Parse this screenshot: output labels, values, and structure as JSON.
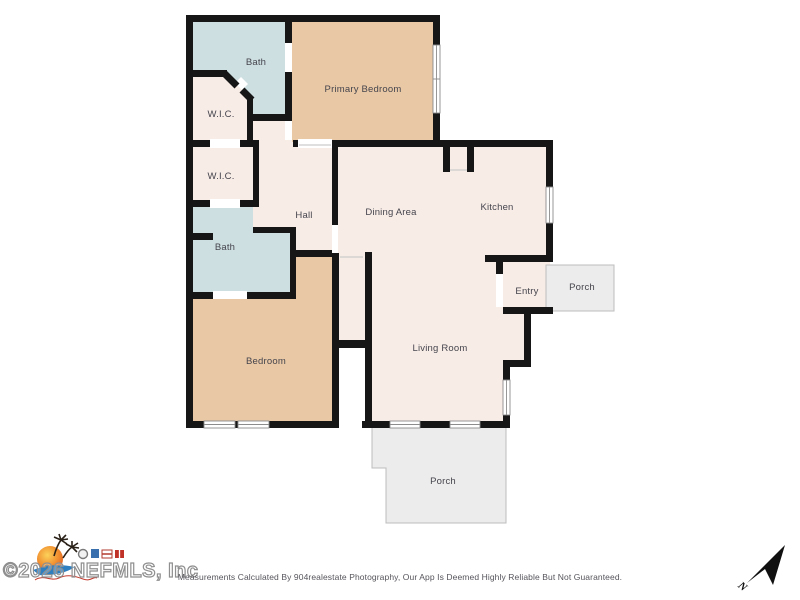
{
  "plan": {
    "rooms": [
      {
        "id": "bath-top",
        "label": "Bath"
      },
      {
        "id": "primary-bedroom",
        "label": "Primary Bedroom"
      },
      {
        "id": "wic-1",
        "label": "W.I.C."
      },
      {
        "id": "wic-2",
        "label": "W.I.C."
      },
      {
        "id": "hall",
        "label": "Hall"
      },
      {
        "id": "dining-area",
        "label": "Dining Area"
      },
      {
        "id": "kitchen",
        "label": "Kitchen"
      },
      {
        "id": "bath-lower",
        "label": "Bath"
      },
      {
        "id": "entry",
        "label": "Entry"
      },
      {
        "id": "porch-side",
        "label": "Porch"
      },
      {
        "id": "bedroom",
        "label": "Bedroom"
      },
      {
        "id": "living-room",
        "label": "Living Room"
      },
      {
        "id": "porch-rear",
        "label": "Porch"
      }
    ]
  },
  "watermark": "©2026 NEFMLS, Inc",
  "footer": {
    "disclaimer": "Measurements Calculated By 904realestate Photography, Our App Is Deemed Highly Reliable But Not Guaranteed."
  },
  "compass": {
    "label": "N"
  },
  "icons": {
    "compass": "north-arrow-icon",
    "logo": "sun-palm-trees-logo"
  },
  "colors": {
    "wall": "#161616",
    "floor": "#f8ece7",
    "bedroom_fill": "#e9c8a5",
    "bath_fill": "#cedfe2",
    "porch_fill": "#ececec",
    "label_text": "#45454d"
  }
}
